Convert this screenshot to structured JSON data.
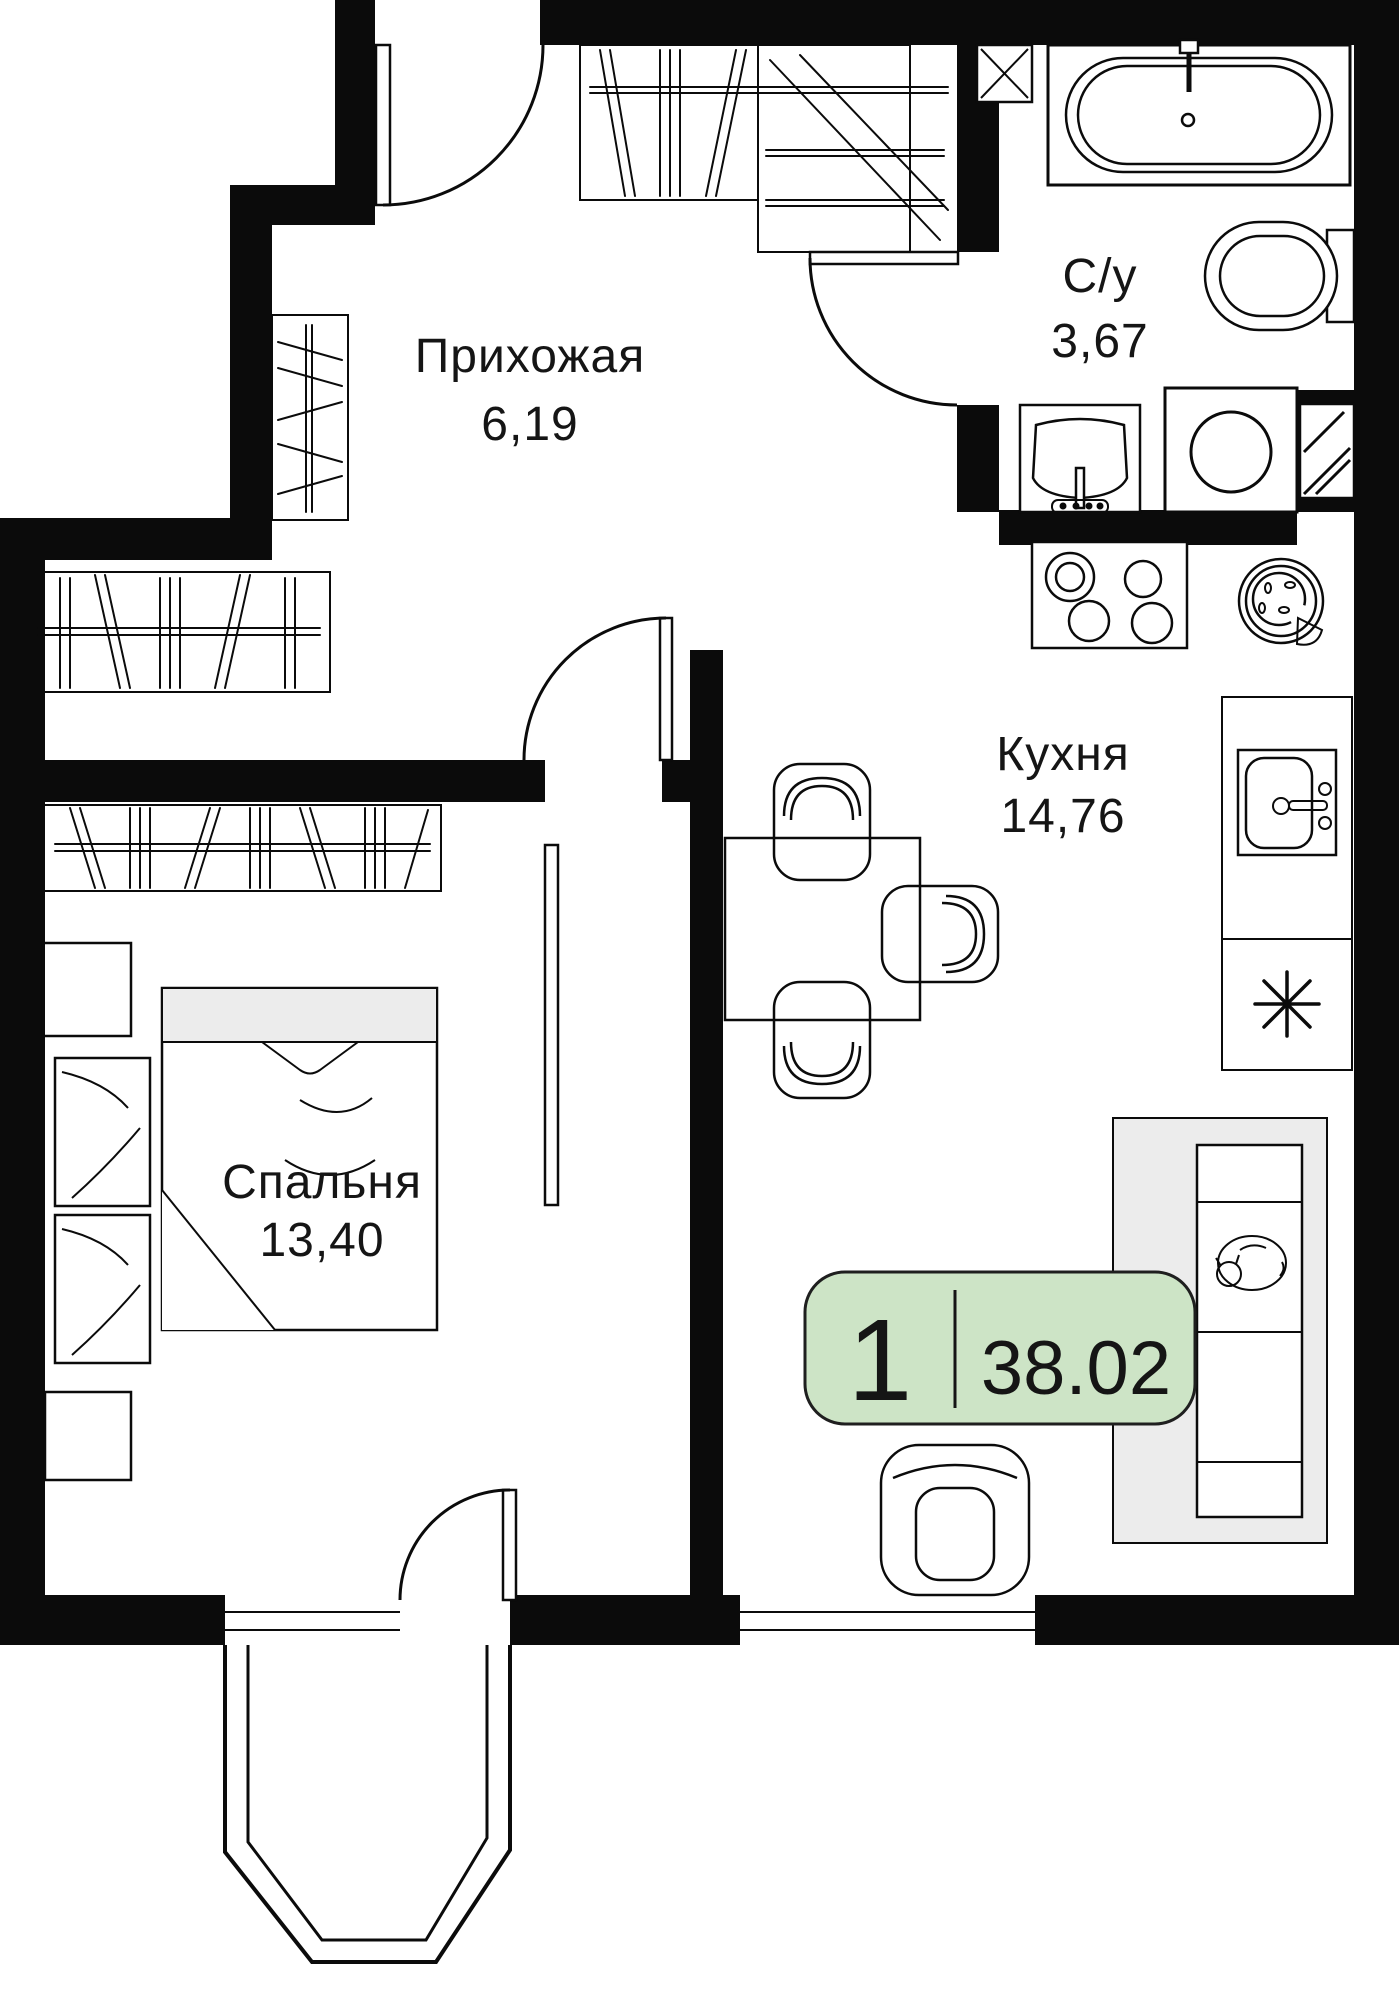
{
  "floorplan": {
    "type": "apartment-floor-plan",
    "language": "ru",
    "rooms": [
      {
        "name": "Прихожая",
        "area": "6,19"
      },
      {
        "name": "С/у",
        "area": "3,67"
      },
      {
        "name": "Кухня",
        "area": "14,76"
      },
      {
        "name": "Спальня",
        "area": "13,40"
      }
    ],
    "badge": {
      "rooms_count": "1",
      "total_area": "38.02"
    },
    "colors": {
      "walls": "#0b0b0b",
      "badge_bg": "#cde4c6",
      "badge_border": "#1f1f1f",
      "soft_fill": "#ececec"
    },
    "icons": [
      "bathtub-icon",
      "toilet-icon",
      "washbasin-icon",
      "washing-machine-icon",
      "stove-icon",
      "pizza-plate-icon",
      "kitchen-sink-icon",
      "fridge-asterisk-icon",
      "dining-table",
      "chair",
      "sofa",
      "cat-icon",
      "armchair",
      "bed",
      "wardrobe-icon",
      "entrance-door",
      "interior-door",
      "balcony",
      "window",
      "vent-shaft-icon"
    ]
  }
}
